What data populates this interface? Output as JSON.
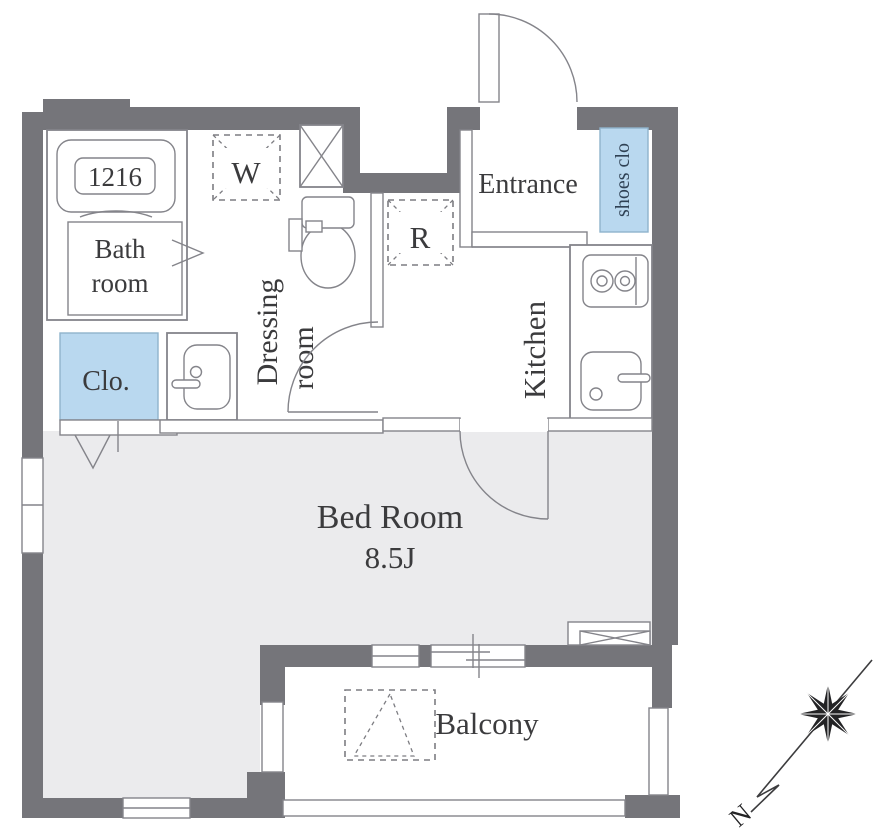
{
  "floorplan": {
    "bathtub_label": "1216",
    "rooms": {
      "bathroom": {
        "line1": "Bath",
        "line2": "room"
      },
      "closet": "Clo.",
      "washer_symbol": "W",
      "refrigerator_symbol": "R",
      "dressing_room": {
        "line1": "Dressing",
        "line2": "room"
      },
      "entrance": "Entrance",
      "shoes_closet": "shoes clo",
      "kitchen": "Kitchen",
      "bedroom": {
        "name": "Bed Room",
        "size": "8.5J"
      },
      "balcony": "Balcony"
    },
    "compass": {
      "north_label": "N"
    },
    "colors": {
      "wall": "#75757a",
      "bedroom_floor": "#ebebed",
      "closet_fill": "#b9d8ef",
      "closet_border": "#8fb3cc",
      "closet_text": "#2f4154",
      "line": "#84848a",
      "text": "#3b3b3d"
    }
  }
}
